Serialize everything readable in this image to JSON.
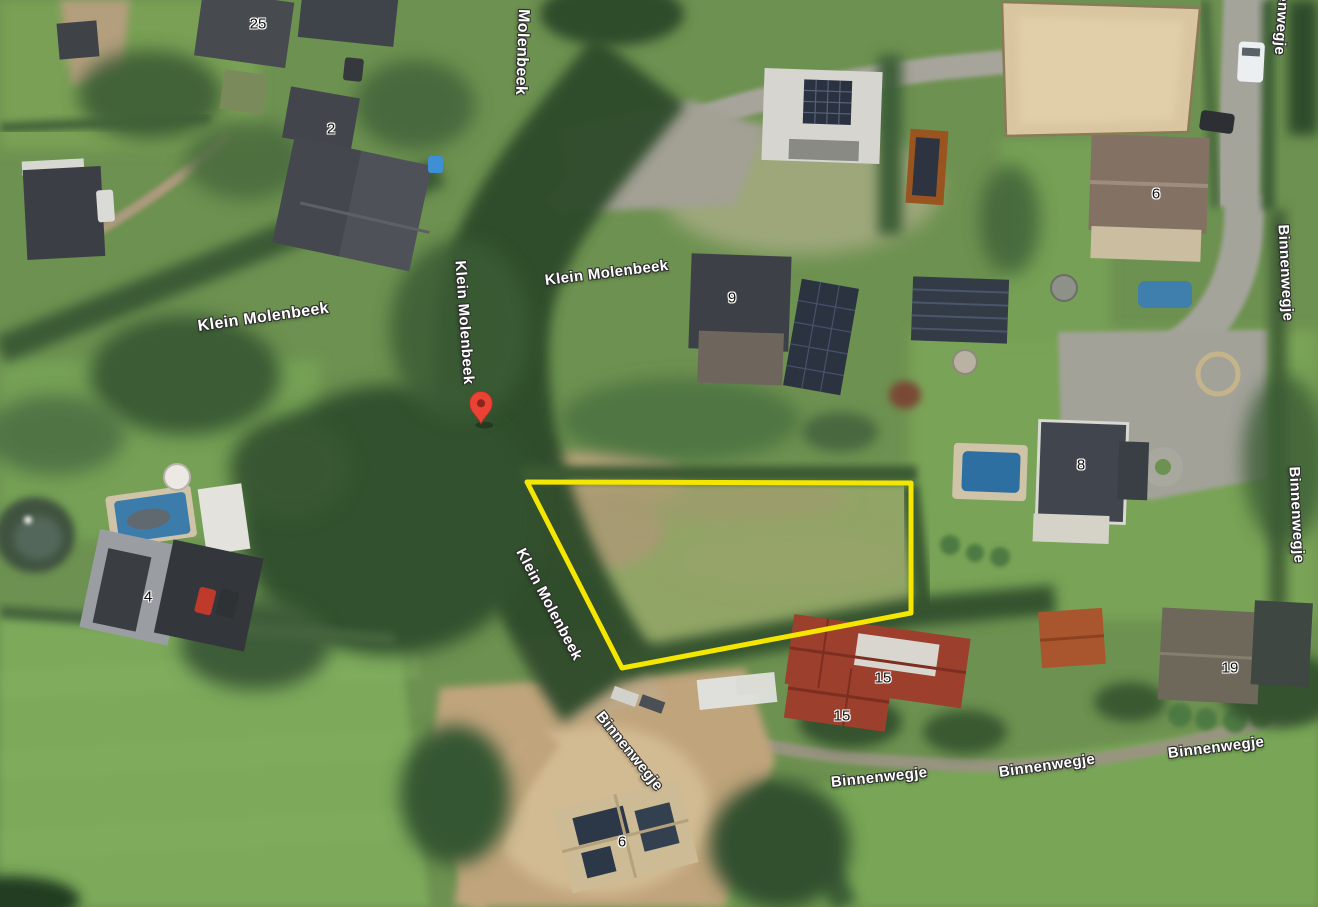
{
  "map": {
    "view_type": "satellite-aerial",
    "road_labels": [
      {
        "id": "klein-molenbeek-west",
        "text": "Klein Molenbeek",
        "x": 198,
        "y": 318,
        "rotate": -8,
        "size": 16
      },
      {
        "id": "molenbeek-north",
        "text": "Molenbeek",
        "x": 523,
        "y": 0,
        "rotate": 92,
        "size": 16
      },
      {
        "id": "klein-molenbeek-upper",
        "text": "Klein Molenbeek",
        "x": 545,
        "y": 272,
        "rotate": -7,
        "size": 15
      },
      {
        "id": "klein-molenbeek-stream",
        "text": "Klein Molenbeek",
        "x": 460,
        "y": 252,
        "rotate": 86,
        "size": 15
      },
      {
        "id": "klein-molenbeek-lower",
        "text": "Klein Molenbeek",
        "x": 520,
        "y": 541,
        "rotate": 62,
        "size": 15
      },
      {
        "id": "binnenwegje-southwest",
        "text": "Binnenwegje",
        "x": 599,
        "y": 705,
        "rotate": 51,
        "size": 15
      },
      {
        "id": "binnenwegje-south-1",
        "text": "Binnenwegje",
        "x": 831,
        "y": 774,
        "rotate": -6,
        "size": 15
      },
      {
        "id": "binnenwegje-south-2",
        "text": "Binnenwegje",
        "x": 999,
        "y": 764,
        "rotate": -8,
        "size": 15
      },
      {
        "id": "binnenwegje-south-3",
        "text": "Binnenwegje",
        "x": 1168,
        "y": 745,
        "rotate": -7,
        "size": 15
      },
      {
        "id": "binnenwegje-east-top",
        "text": "Binnenwegje",
        "x": 1286,
        "y": -50,
        "rotate": 94,
        "size": 15
      },
      {
        "id": "binnenwegje-east-mid",
        "text": "Binnenwegje",
        "x": 1283,
        "y": 216,
        "rotate": 87,
        "size": 15
      },
      {
        "id": "binnenwegje-east-low",
        "text": "Binnenwegje",
        "x": 1294,
        "y": 458,
        "rotate": 87,
        "size": 15
      }
    ],
    "house_numbers": [
      {
        "text": "25",
        "x": 258,
        "y": 24
      },
      {
        "text": "2",
        "x": 331,
        "y": 129
      },
      {
        "text": "9",
        "x": 732,
        "y": 298
      },
      {
        "text": "6",
        "x": 1156,
        "y": 194
      },
      {
        "text": "8",
        "x": 1081,
        "y": 465
      },
      {
        "text": "4",
        "x": 148,
        "y": 597
      },
      {
        "text": "15",
        "x": 883,
        "y": 678
      },
      {
        "text": "15",
        "x": 842,
        "y": 716
      },
      {
        "text": "19",
        "x": 1230,
        "y": 668
      },
      {
        "text": "6",
        "x": 622,
        "y": 842
      }
    ],
    "marker": {
      "type": "red-location-pin",
      "tip_x": 481,
      "tip_y": 424,
      "color": "#EA4335",
      "inner_color": "#8A251C"
    },
    "parcel_outline": {
      "color": "#F5E600",
      "stroke_width": 5,
      "points": "527,482 911,483 911,613 622,668"
    }
  }
}
